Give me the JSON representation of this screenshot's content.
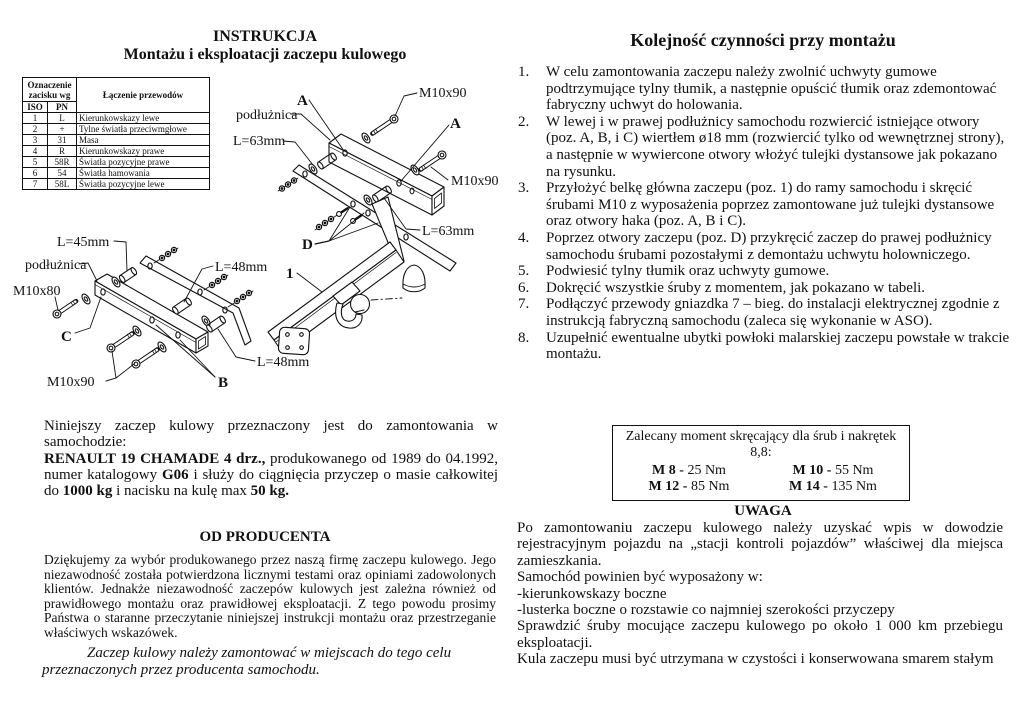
{
  "left": {
    "title1": "INSTRUKCJA",
    "title2": "Montażu i eksploatacji zaczepu kulowego",
    "wiring_table": {
      "col_group_header": "Oznaczenie zacisku wg",
      "col_desc_header": "Łączenie przewodów",
      "sub_iso": "ISO",
      "sub_pn": "PN",
      "rows": [
        {
          "iso": "1",
          "pn": "L",
          "desc": "Kierunkowskazy lewe"
        },
        {
          "iso": "2",
          "pn": "+",
          "desc": "Tylne światła przeciwmgłowe"
        },
        {
          "iso": "3",
          "pn": "31",
          "desc": "Masa"
        },
        {
          "iso": "4",
          "pn": "R",
          "desc": "Kierunkowskazy prawe"
        },
        {
          "iso": "5",
          "pn": "58R",
          "desc": "Światła pozycyjne prawe"
        },
        {
          "iso": "6",
          "pn": "54",
          "desc": "Światła hamowania"
        },
        {
          "iso": "7",
          "pn": "58L",
          "desc": "Światła pozycyjne lewe"
        }
      ]
    },
    "diagram": {
      "a_top": "A",
      "m10x90_top": "M10x90",
      "podluznica_top": "podłużnica",
      "l63_left": "L=63mm",
      "a_right": "A",
      "m10x90_right": "M10x90",
      "l63_right": "L=63mm",
      "d": "D",
      "l45": "L=45mm",
      "podluznica_left": "podłużnica",
      "m10x80": "M10x80",
      "c": "C",
      "l48_top": "L=48mm",
      "pos1": "1",
      "l48_bottom": "L=48mm",
      "m10x90_bottom": "M10x90",
      "b": "B"
    },
    "intro": {
      "p1": "Niniejszy zaczep kulowy przeznaczony jest do zamontowania w samochodzie:",
      "bold1": "RENAULT 19 CHAMADE 4 drz.,",
      "t1": " produkowanego od 1989 do 04.1992, numer katalogowy ",
      "bold2": "G06",
      "t2": " i służy do ciągnięcia przyczep o masie całkowitej do ",
      "bold3": "1000 kg",
      "t3": " i nacisku na kulę max ",
      "bold4": "50 kg."
    },
    "producer": {
      "heading": "OD PRODUCENTA",
      "body": "Dziękujemy za wybór produkowanego przez naszą firmę zaczepu kulowego. Jego niezawodność została potwierdzona licznymi testami oraz opiniami zadowolonych klientów. Jednakże niezawodność zaczepów kulowych jest zależna również od prawidłowego montażu oraz prawidłowej eksploatacji. Z tego powodu prosimy Państwa o staranne przeczytanie niniejszej instrukcji montażu oraz przestrzeganie właściwych wskazówek.",
      "note": "Zaczep kulowy należy zamontować w miejscach do tego celu przeznaczonych przez producenta samochodu."
    }
  },
  "right": {
    "title": "Kolejność czynności przy montażu",
    "steps": [
      {
        "num": "1.",
        "text": "W celu zamontowania zaczepu należy zwolnić uchwyty gumowe podtrzymujące tylny tłumik, a następnie opuścić tłumik oraz zdemontować fabryczny uchwyt do holowania."
      },
      {
        "num": "2.",
        "text": "W lewej i w prawej podłużnicy samochodu rozwiercić istniejące otwory (poz. A, B, i C) wiertłem ø18 mm (rozwiercić tylko od wewnętrznej strony), a następnie w wywiercone otwory włożyć tulejki dystansowe jak pokazano na rysunku."
      },
      {
        "num": "3.",
        "text": "Przyłożyć belkę główna zaczepu (poz. 1) do ramy samochodu i skręcić śrubami M10 z wyposażenia poprzez zamontowane już tulejki dystansowe oraz otwory haka (poz. A, B i C)."
      },
      {
        "num": "4.",
        "text": "Poprzez otwory zaczepu (poz. D) przykręcić zaczep do prawej podłużnicy samochodu śrubami pozostałymi z demontażu uchwytu holowniczego."
      },
      {
        "num": "5.",
        "text": "Podwiesić tylny tłumik oraz uchwyty gumowe."
      },
      {
        "num": "6.",
        "text": "Dokręcić wszystkie śruby z momentem, jak pokazano w tabeli."
      },
      {
        "num": "7.",
        "text": "Podłączyć przewody gniazdka 7 – bieg. do instalacji elektrycznej zgodnie z instrukcją fabryczną samochodu (zaleca się wykonanie w ASO)."
      },
      {
        "num": "8.",
        "text": "Uzupełnić ewentualne ubytki powłoki malarskiej zaczepu powstałe w trakcie montażu."
      }
    ],
    "torque_box": {
      "title": "Zalecany moment skręcający dla śrub i nakrętek 8,8:",
      "items": [
        {
          "label": "M 8 -",
          "value": " 25 Nm"
        },
        {
          "label": "M 10 -",
          "value": " 55 Nm"
        },
        {
          "label": "M 12 -",
          "value": " 85 Nm"
        },
        {
          "label": "M 14 -",
          "value": " 135 Nm"
        }
      ]
    },
    "notice": {
      "heading": "UWAGA",
      "p1": "Po zamontowaniu zaczepu kulowego należy uzyskać wpis w dowodzie rejestracyjnym pojazdu na „stacji kontroli pojazdów” właściwej dla miejsca zamieszkania.",
      "p2": "Samochód powinien być wyposażony w:",
      "p3": "-kierunkowskazy boczne",
      "p4": "-lusterka boczne o rozstawie co najmniej szerokości przyczepy",
      "p5": "Sprawdzić śruby mocujące zaczepu kulowego po około 1 000 km przebiegu eksploatacji.",
      "p6": "Kula zaczepu musi być utrzymana w czystości i konserwowana smarem stałym"
    }
  }
}
